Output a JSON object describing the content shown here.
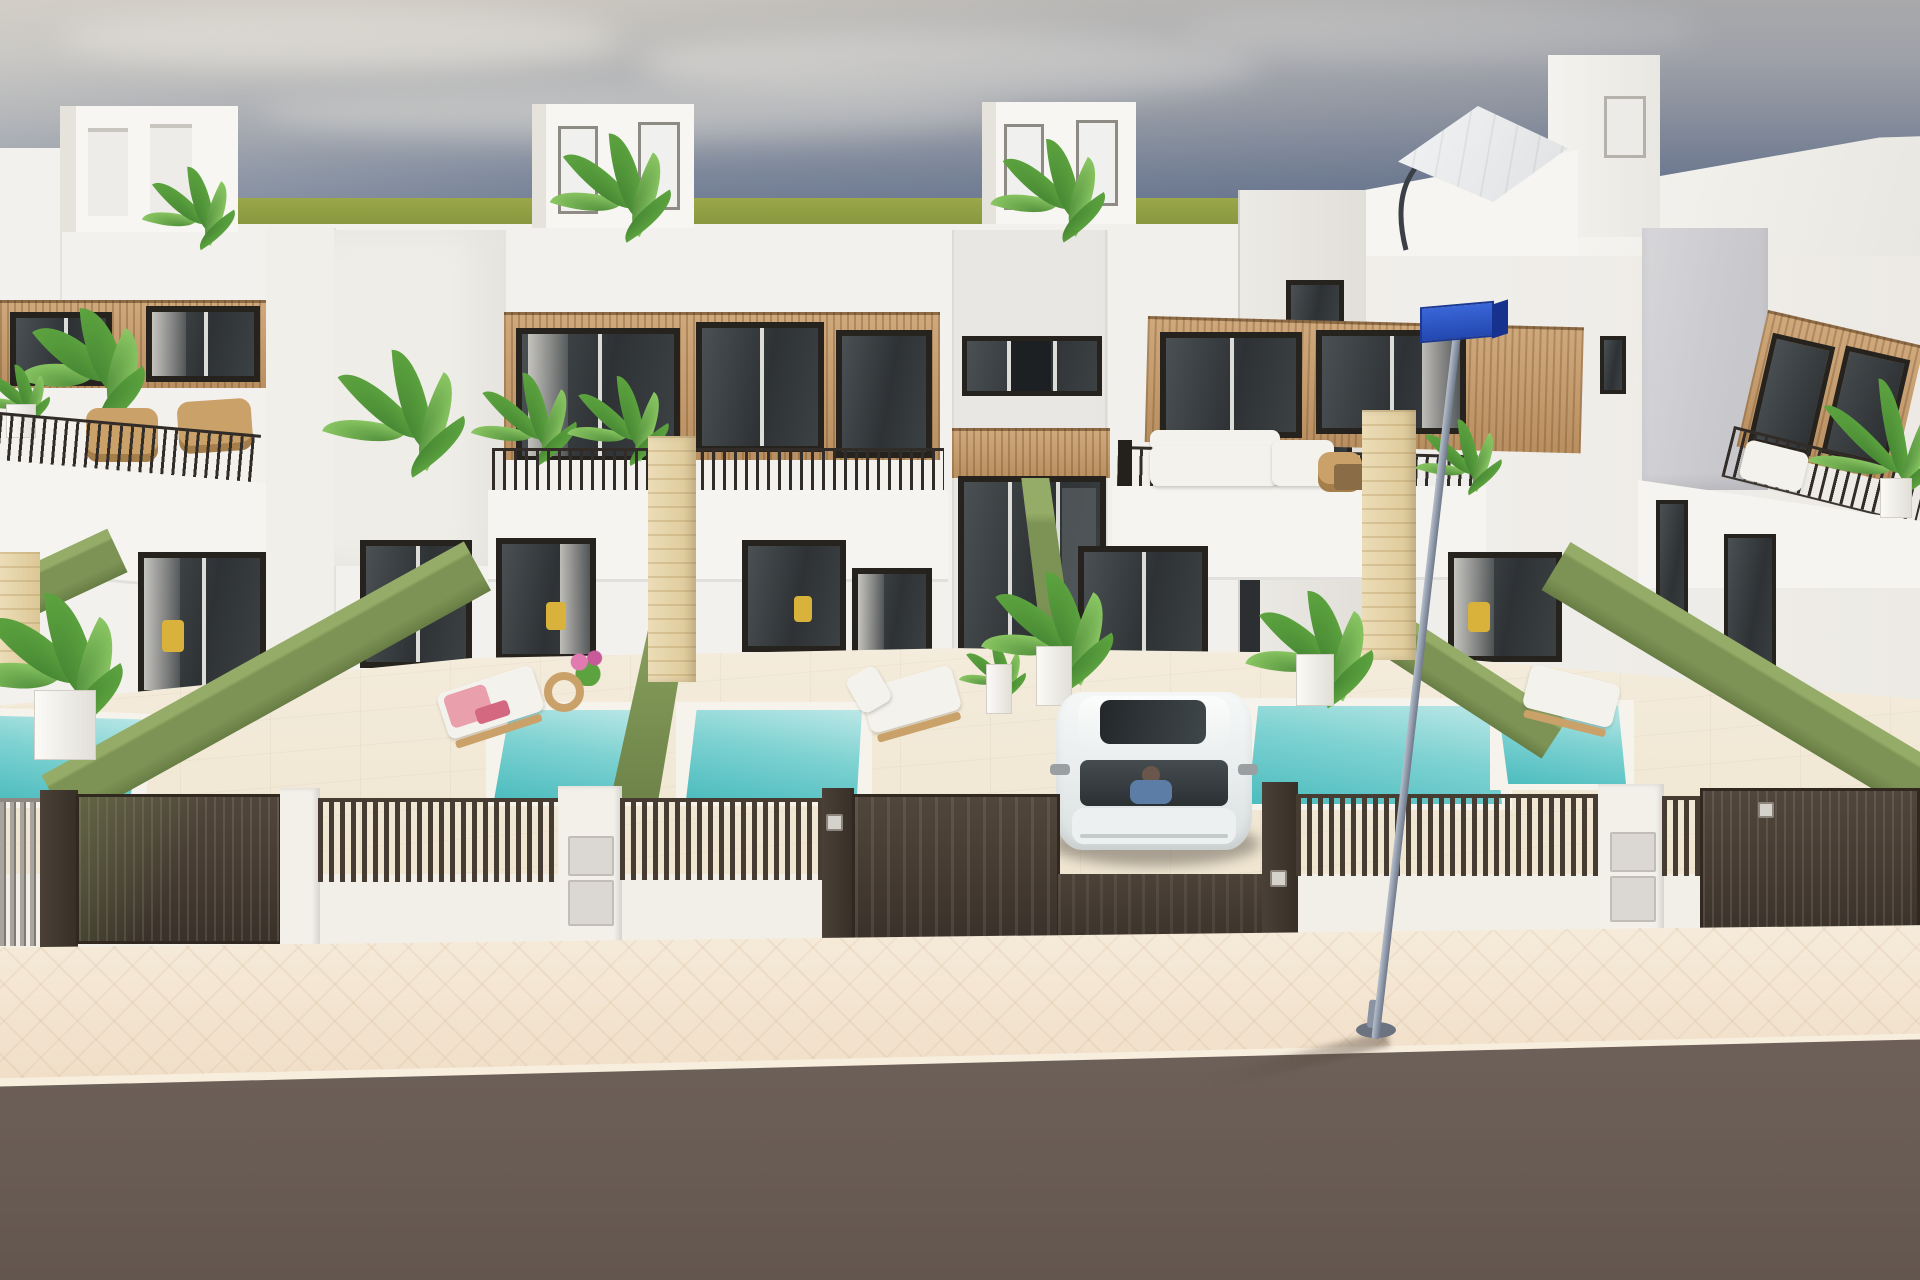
{
  "scene": {
    "title": "3D architectural rendering of a row of modern white townhouses with private pools on a street",
    "width_px": 1920,
    "height_px": 1280
  },
  "palette": {
    "sky_top": "#cac6bf",
    "sky_mid": "#a2a6ad",
    "sky_low": "#6d7992",
    "sky_deep": "#5f6d8a",
    "cloud": "#e6e3dc",
    "grass": "#95a344",
    "grass_dark": "#7f8f38",
    "wall": "#f3f1ed",
    "wall_soft": "#eae7e2",
    "wall_shade": "#d9d6d0",
    "tower_grey": "#d7d6d9",
    "wood": "#c59c6e",
    "wood_dark": "#a37b4e",
    "stone": "#e8d8b0",
    "stone_line": "#d8c493",
    "frame": "#26221d",
    "glass": "#383c3f",
    "glass_light": "#7a8287",
    "hedge": "#7d9355",
    "hedge_top": "#95ac68",
    "hedge_dark": "#687d44",
    "pool_light": "#bce8e7",
    "pool": "#7fd2d2",
    "pool_deep": "#4cbcbe",
    "paving": "#f1e8d6",
    "paving_line": "#e3d7c0",
    "fence": "#463c32",
    "fence_hi": "#5d5146",
    "fence_grey": "#a9a59e",
    "pillar_white": "#f3f0ea",
    "panel": "#dbd7d2",
    "sidewalk": "#f3e6d2",
    "kerb": "#f8eede",
    "road": "#6b5f58",
    "pole": "#9aa3b2",
    "sign": "#2a54c2",
    "sign_dark": "#16328e",
    "car": "#eef1f1",
    "car_glass": "#31363a",
    "cushion": "#f4f2ed",
    "wood_furn": "#c9a169",
    "towel": "#e9a0ac",
    "towel_dark": "#d36880",
    "leaf": "#5ca33f",
    "leaf_dark": "#3f7d2f",
    "leaf_light": "#8fcb66"
  },
  "objects": {
    "sky": "overcast blue-grey sky with soft clouds",
    "horizon": "flat olive-green field at the horizon",
    "houses": "row of white two-storey townhouses with wood-slat facade panels and rooftop terraces",
    "rooftop_structures": "white stair bulkheads with doors and rooftop plants",
    "parasol": "white cantilever parasol on the right rooftop terrace",
    "balconies": "balconies with thin dark railings, rattan chairs, white sofas and potted plants",
    "pools": "five small turquoise private plunge pools behind the street fence",
    "hedges": "green hedge walls separating the front yards",
    "fence": "dark brown slatted street fence with gates, white pillars, letterbox panels and keypads",
    "car": "white car with driver parked in the open driveway",
    "loungers": "wooden sun loungers with white cushions, one with pink towels, plus a wooden side stool",
    "street_lamp": "grey street lamp post with a blue street sign, standing on the sidewalk",
    "sidewalk": "beige herringbone paved sidewalk",
    "road": "grey asphalt road in the foreground"
  }
}
